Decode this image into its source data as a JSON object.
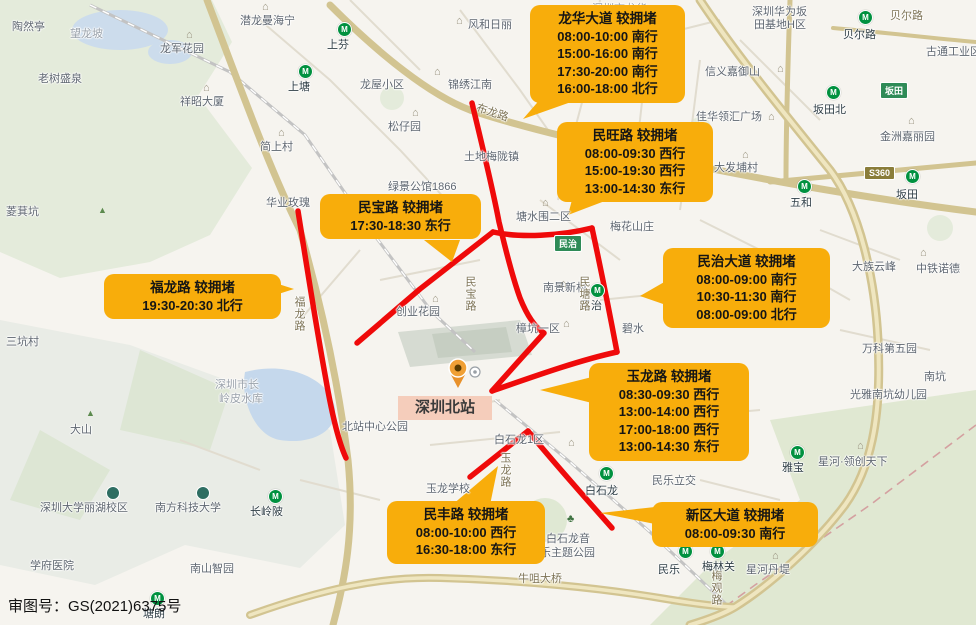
{
  "attribution": "审图号：GS(2021)6375号",
  "station_card": {
    "label": "深圳北站"
  },
  "colors": {
    "congestion_red": "#ef0a0a",
    "callout_orange": "#F8AD0B",
    "station_pink": "#F5CDBB",
    "metro_green": "#00913f"
  },
  "callouts": [
    {
      "name": "longhua-avenue",
      "title": "龙华大道 较拥堵",
      "lines": [
        "08:00-10:00 南行",
        "15:00-16:00 南行",
        "17:30-20:00 南行",
        "16:00-18:00 北行"
      ],
      "x": 530,
      "y": 5,
      "w": 155
    },
    {
      "name": "minwang-road",
      "title": "民旺路 较拥堵",
      "lines": [
        "08:00-09:30 西行",
        "15:00-19:30 西行",
        "13:00-14:30 东行"
      ],
      "x": 557,
      "y": 122,
      "w": 156
    },
    {
      "name": "minbao-road",
      "title": "民宝路 较拥堵",
      "lines": [
        "17:30-18:30 东行"
      ],
      "x": 320,
      "y": 194,
      "w": 161
    },
    {
      "name": "fulong-road",
      "title": "福龙路 较拥堵",
      "lines": [
        "19:30-20:30 北行"
      ],
      "x": 104,
      "y": 274,
      "w": 177
    },
    {
      "name": "minzhi-avenue",
      "title": "民治大道 较拥堵",
      "lines": [
        "08:00-09:00 南行",
        "10:30-11:30 南行",
        "08:00-09:00 北行"
      ],
      "x": 663,
      "y": 248,
      "w": 167
    },
    {
      "name": "yulong-road",
      "title": "玉龙路 较拥堵",
      "lines": [
        "08:30-09:30 西行",
        "13:00-14:00 西行",
        "17:00-18:00 西行",
        "13:00-14:30 东行"
      ],
      "x": 589,
      "y": 363,
      "w": 160
    },
    {
      "name": "minfeng-road",
      "title": "民丰路 较拥堵",
      "lines": [
        "08:00-10:00 西行",
        "16:30-18:00 东行"
      ],
      "x": 387,
      "y": 501,
      "w": 158
    },
    {
      "name": "xinqu-avenue",
      "title": "新区大道 较拥堵",
      "lines": [
        "08:00-09:30 南行"
      ],
      "x": 652,
      "y": 502,
      "w": 166
    }
  ],
  "map_shields": [
    {
      "t": "民治",
      "x": 554,
      "y": 235
    },
    {
      "t": "坂田",
      "x": 880,
      "y": 82
    },
    {
      "t": "S360",
      "x": 864,
      "y": 166,
      "s": "expwy"
    }
  ],
  "map_labels": [
    {
      "t": "陶然亭",
      "x": 12,
      "y": 18,
      "c": ""
    },
    {
      "t": "望龙坡",
      "x": 70,
      "y": 25,
      "c": "faint"
    },
    {
      "t": "老树盛泉",
      "x": 38,
      "y": 70,
      "c": ""
    },
    {
      "t": "龙军花园",
      "x": 160,
      "y": 40,
      "c": ""
    },
    {
      "t": "祥昭大厦",
      "x": 180,
      "y": 93,
      "c": ""
    },
    {
      "t": "潜龙曼海宁",
      "x": 240,
      "y": 12,
      "c": ""
    },
    {
      "t": "上塘",
      "x": 288,
      "y": 78,
      "c": "metro-name"
    },
    {
      "t": "简上村",
      "x": 260,
      "y": 138,
      "c": ""
    },
    {
      "t": "华业玫瑰",
      "x": 266,
      "y": 194,
      "c": ""
    },
    {
      "t": "菱萁坑",
      "x": 6,
      "y": 203,
      "c": ""
    },
    {
      "t": "三坑村",
      "x": 6,
      "y": 333,
      "c": ""
    },
    {
      "t": "大头岭",
      "x": 176,
      "y": 289,
      "c": ""
    },
    {
      "t": "上芬",
      "x": 327,
      "y": 36,
      "c": "metro-name"
    },
    {
      "t": "龙屋小区",
      "x": 360,
      "y": 76,
      "c": ""
    },
    {
      "t": "松仔园",
      "x": 388,
      "y": 118,
      "c": ""
    },
    {
      "t": "锦绣江南",
      "x": 448,
      "y": 76,
      "c": ""
    },
    {
      "t": "风和日丽",
      "x": 468,
      "y": 16,
      "c": ""
    },
    {
      "t": "布龙路",
      "x": 476,
      "y": 104,
      "c": "road",
      "rot": 18
    },
    {
      "t": "土地梅陇镇",
      "x": 464,
      "y": 148,
      "c": ""
    },
    {
      "t": "绿景公馆1866",
      "x": 388,
      "y": 178,
      "c": ""
    },
    {
      "t": "红山",
      "x": 382,
      "y": 219,
      "c": "metro-name"
    },
    {
      "t": "塘水围二区",
      "x": 516,
      "y": 208,
      "c": ""
    },
    {
      "t": "梅花山庄",
      "x": 610,
      "y": 218,
      "c": ""
    },
    {
      "t": "南景新村",
      "x": 543,
      "y": 279,
      "c": ""
    },
    {
      "t": "民治",
      "x": 580,
      "y": 297,
      "c": "metro-name"
    },
    {
      "t": "碧水",
      "x": 622,
      "y": 320,
      "c": ""
    },
    {
      "t": "樟坑一区",
      "x": 516,
      "y": 320,
      "c": ""
    },
    {
      "t": "创业花园",
      "x": 396,
      "y": 303,
      "c": ""
    },
    {
      "t": "民宝路",
      "x": 462,
      "y": 276,
      "c": "road vert"
    },
    {
      "t": "福龙路",
      "x": 291,
      "y": 296,
      "c": "road vert"
    },
    {
      "t": "民塘路",
      "x": 576,
      "y": 276,
      "c": "road vert"
    },
    {
      "t": "北站中心公园",
      "x": 342,
      "y": 418,
      "c": ""
    },
    {
      "t": "玉龙学校",
      "x": 426,
      "y": 480,
      "c": ""
    },
    {
      "t": "玉龙路",
      "x": 497,
      "y": 452,
      "c": "road vert"
    },
    {
      "t": "白石龙1区",
      "x": 494,
      "y": 431,
      "c": ""
    },
    {
      "t": "白石龙",
      "x": 585,
      "y": 482,
      "c": "metro-name"
    },
    {
      "t": "民乐立交",
      "x": 652,
      "y": 472,
      "c": ""
    },
    {
      "t": "白石龙音",
      "x": 546,
      "y": 530,
      "c": ""
    },
    {
      "t": "乐主题公园",
      "x": 540,
      "y": 544,
      "c": ""
    },
    {
      "t": "牛咀大桥",
      "x": 518,
      "y": 570,
      "c": "road"
    },
    {
      "t": "雅宝",
      "x": 782,
      "y": 459,
      "c": "metro-name"
    },
    {
      "t": "星河·领创天下",
      "x": 818,
      "y": 453,
      "c": ""
    },
    {
      "t": "梅林关",
      "x": 702,
      "y": 558,
      "c": "metro-name"
    },
    {
      "t": "星河丹堤",
      "x": 746,
      "y": 561,
      "c": ""
    },
    {
      "t": "民乐",
      "x": 658,
      "y": 561,
      "c": "metro-name"
    },
    {
      "t": "梅观路",
      "x": 708,
      "y": 570,
      "c": "road vert"
    },
    {
      "t": "塘朗",
      "x": 143,
      "y": 605,
      "c": "metro-name"
    },
    {
      "t": "学府医院",
      "x": 30,
      "y": 557,
      "c": ""
    },
    {
      "t": "南山智园",
      "x": 190,
      "y": 560,
      "c": ""
    },
    {
      "t": "深圳大学丽湖校区",
      "x": 40,
      "y": 499,
      "c": ""
    },
    {
      "t": "南方科技大学",
      "x": 155,
      "y": 499,
      "c": ""
    },
    {
      "t": "长岭陂",
      "x": 250,
      "y": 503,
      "c": "metro-name"
    },
    {
      "t": "大山",
      "x": 70,
      "y": 421,
      "c": ""
    },
    {
      "t": "深圳市长",
      "x": 215,
      "y": 376,
      "c": "faint"
    },
    {
      "t": "岭皮水库",
      "x": 219,
      "y": 390,
      "c": "faint"
    },
    {
      "t": "深圳华为坂",
      "x": 752,
      "y": 3,
      "c": ""
    },
    {
      "t": "田基地H区",
      "x": 754,
      "y": 16,
      "c": ""
    },
    {
      "t": "贝尔路",
      "x": 843,
      "y": 26,
      "c": "metro-name"
    },
    {
      "t": "贝尔路",
      "x": 890,
      "y": 7,
      "c": "road"
    },
    {
      "t": "古通工业区",
      "x": 926,
      "y": 43,
      "c": ""
    },
    {
      "t": "信义嘉御山",
      "x": 705,
      "y": 63,
      "c": ""
    },
    {
      "t": "佳华领汇广场",
      "x": 696,
      "y": 108,
      "c": ""
    },
    {
      "t": "坂田北",
      "x": 813,
      "y": 101,
      "c": "metro-name"
    },
    {
      "t": "金洲嘉丽园",
      "x": 880,
      "y": 128,
      "c": ""
    },
    {
      "t": "大发埔村",
      "x": 714,
      "y": 159,
      "c": ""
    },
    {
      "t": "坂田",
      "x": 896,
      "y": 186,
      "c": "metro-name"
    },
    {
      "t": "五和",
      "x": 790,
      "y": 194,
      "c": "metro-name"
    },
    {
      "t": "大族云峰",
      "x": 852,
      "y": 258,
      "c": ""
    },
    {
      "t": "中铁诺德",
      "x": 916,
      "y": 260,
      "c": ""
    },
    {
      "t": "万科第五园",
      "x": 862,
      "y": 340,
      "c": ""
    },
    {
      "t": "南坑",
      "x": 924,
      "y": 368,
      "c": ""
    },
    {
      "t": "光雅南坑幼儿园",
      "x": 850,
      "y": 386,
      "c": ""
    },
    {
      "t": "深圳市龙华",
      "x": 592,
      "y": 0,
      "c": "faint"
    }
  ],
  "map_icons": [
    {
      "type": "metro-station-icon",
      "x": 298,
      "y": 64
    },
    {
      "type": "metro-station-icon",
      "x": 337,
      "y": 22
    },
    {
      "type": "metro-station-icon",
      "x": 393,
      "y": 205
    },
    {
      "type": "metro-station-icon",
      "x": 590,
      "y": 283
    },
    {
      "type": "metro-station-icon",
      "x": 599,
      "y": 466
    },
    {
      "type": "metro-station-icon",
      "x": 790,
      "y": 445
    },
    {
      "type": "metro-station-icon",
      "x": 710,
      "y": 544
    },
    {
      "type": "metro-station-icon",
      "x": 678,
      "y": 544
    },
    {
      "type": "metro-station-icon",
      "x": 826,
      "y": 85
    },
    {
      "type": "metro-station-icon",
      "x": 905,
      "y": 169
    },
    {
      "type": "metro-station-icon",
      "x": 797,
      "y": 179
    },
    {
      "type": "metro-station-icon",
      "x": 858,
      "y": 10
    },
    {
      "type": "metro-station-icon",
      "x": 268,
      "y": 489
    },
    {
      "type": "metro-station-icon",
      "x": 150,
      "y": 591
    },
    {
      "type": "building-icon",
      "x": 456,
      "y": 16
    },
    {
      "type": "building-icon",
      "x": 434,
      "y": 67
    },
    {
      "type": "building-icon",
      "x": 412,
      "y": 108
    },
    {
      "type": "building-icon",
      "x": 186,
      "y": 30
    },
    {
      "type": "building-icon",
      "x": 203,
      "y": 83
    },
    {
      "type": "building-icon",
      "x": 278,
      "y": 128
    },
    {
      "type": "building-icon",
      "x": 262,
      "y": 2
    },
    {
      "type": "building-icon",
      "x": 542,
      "y": 198
    },
    {
      "type": "building-icon",
      "x": 560,
      "y": 279
    },
    {
      "type": "building-icon",
      "x": 563,
      "y": 319
    },
    {
      "type": "building-icon",
      "x": 432,
      "y": 294
    },
    {
      "type": "building-icon",
      "x": 568,
      "y": 438
    },
    {
      "type": "building-icon",
      "x": 908,
      "y": 116
    },
    {
      "type": "building-icon",
      "x": 777,
      "y": 64
    },
    {
      "type": "building-icon",
      "x": 742,
      "y": 150
    },
    {
      "type": "building-icon",
      "x": 768,
      "y": 112
    },
    {
      "type": "building-icon",
      "x": 857,
      "y": 441
    },
    {
      "type": "building-icon",
      "x": 772,
      "y": 551
    },
    {
      "type": "building-icon",
      "x": 920,
      "y": 248
    },
    {
      "type": "mountain-icon",
      "x": 98,
      "y": 206
    },
    {
      "type": "mountain-icon",
      "x": 172,
      "y": 284
    },
    {
      "type": "mountain-icon",
      "x": 86,
      "y": 409
    },
    {
      "type": "tree-icon",
      "x": 567,
      "y": 514
    },
    {
      "type": "school-icon",
      "x": 106,
      "y": 486
    },
    {
      "type": "school-icon",
      "x": 196,
      "y": 486
    }
  ]
}
